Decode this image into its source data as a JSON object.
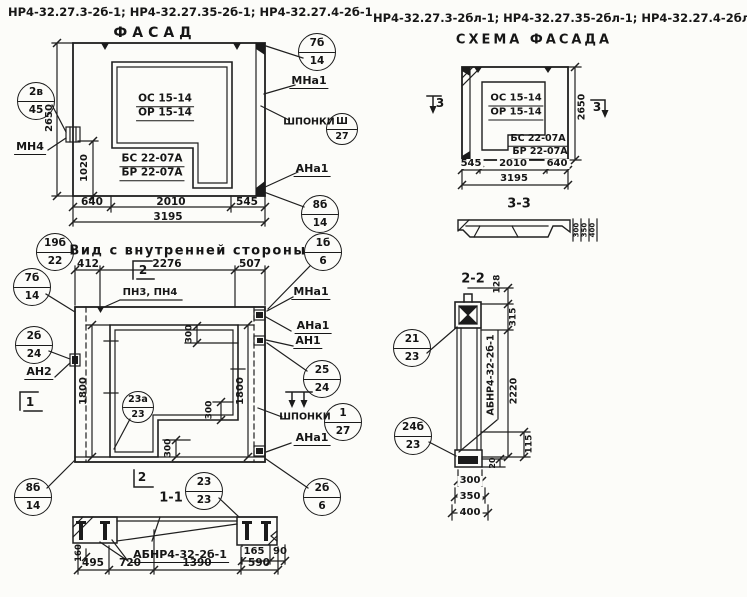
{
  "title_left": {
    "codes": "НР4-32.27.3-2б-1; НР4-32.27.35-2б-1; НР4-32.27.4-2б-1",
    "subtitle": "ФАСАД"
  },
  "title_right": {
    "codes": "НР4-32.27.3-2бл-1; НР4-32.27.35-2бл-1; НР4-32.27.4-2бл-1",
    "subtitle": "СХЕМА ФАСАДА"
  },
  "facade": {
    "window_mark_top": "ОС 15-14",
    "window_mark_bottom": "ОР 15-14",
    "block_mark_top": "БС 22-07А",
    "block_mark_bottom": "БР 22-07А",
    "dim_height": "2650",
    "dim_1020": "1020",
    "dim_640": "640",
    "dim_2010": "2010",
    "dim_545": "545",
    "dim_total": "3195",
    "label_mn4": "МН4",
    "label_mna1": "МНа1",
    "label_shponki": "ШПОНКИ",
    "label_ana1": "АНа1",
    "balloon_anchor": {
      "top": "2в",
      "bottom": "45"
    },
    "balloon_top_right": {
      "top": "7б",
      "bottom": "14"
    },
    "balloon_shponki": {
      "top": "Ш",
      "bottom": "27"
    },
    "balloon_bottom_right": {
      "top": "8б",
      "bottom": "14"
    }
  },
  "inner_view": {
    "title": "Вид с внутренней стороны",
    "balloon_title": {
      "top": "19б",
      "bottom": "22"
    },
    "dim_412": "412",
    "dim_2276": "2276",
    "dim_507": "507",
    "label_pn": "ПН3, ПН4",
    "dim_1800_left": "1800",
    "dim_1800_right": "1800",
    "dim_300_top": "300",
    "dim_300_mid": "300",
    "dim_300_bottom": "300",
    "label_mna1": "МНа1",
    "label_ana1_top": "АНа1",
    "label_an1": "АН1",
    "label_shponki": "ШПОНКИ",
    "label_ana1_bottom": "АНа1",
    "label_an2": "АН2",
    "balloon_mna1": {
      "top": "1б",
      "bottom": "6"
    },
    "balloon_left_top": {
      "top": "7б",
      "bottom": "14"
    },
    "balloon_an2": {
      "top": "2б",
      "bottom": "24"
    },
    "balloon_an1": {
      "top": "25",
      "bottom": "24"
    },
    "balloon_shponki": {
      "top": "1",
      "bottom": "27"
    },
    "balloon_corner": {
      "top": "23а",
      "bottom": "23"
    },
    "balloon_bottom_right": {
      "top": "2б",
      "bottom": "6"
    },
    "balloon_bottom_left": {
      "top": "8б",
      "bottom": "14"
    },
    "marker_section1": "1",
    "marker_section2_top": "2",
    "marker_section2_bottom": "2"
  },
  "section_1_1": {
    "title": "1-1",
    "balloon": {
      "top": "23",
      "bottom": "23"
    },
    "label_abnr": "АБНР4-32-2б-1",
    "dim_160": "160",
    "dim_495": "495",
    "dim_720": "720",
    "dim_1390": "1390",
    "dim_590": "590",
    "dim_165": "165",
    "dim_90": "90"
  },
  "schema": {
    "window_mark_top": "ОС 15-14",
    "window_mark_bottom": "ОР 15-14",
    "block_mark_top": "БС 22-07А",
    "block_mark_bottom": "БР 22-07А",
    "dim_545": "545",
    "dim_2010": "2010",
    "dim_640": "640",
    "dim_total": "3195",
    "dim_height": "2650",
    "marker_3_left": "3",
    "marker_3_right": "3",
    "section_label": "3-3",
    "profile_dim_300": "300",
    "profile_dim_350": "350",
    "profile_dim_400": "400"
  },
  "section_2_2": {
    "title": "2-2",
    "label_abnr": "АБНР4-32-2б-1",
    "dim_128": "128",
    "dim_315": "315",
    "dim_2220": "2220",
    "dim_115": "115",
    "dim_20": "20",
    "dim_300": "300",
    "dim_350": "350",
    "dim_400": "400",
    "balloon_top": {
      "top": "21",
      "bottom": "23"
    },
    "balloon_bottom": {
      "top": "24б",
      "bottom": "23"
    }
  }
}
